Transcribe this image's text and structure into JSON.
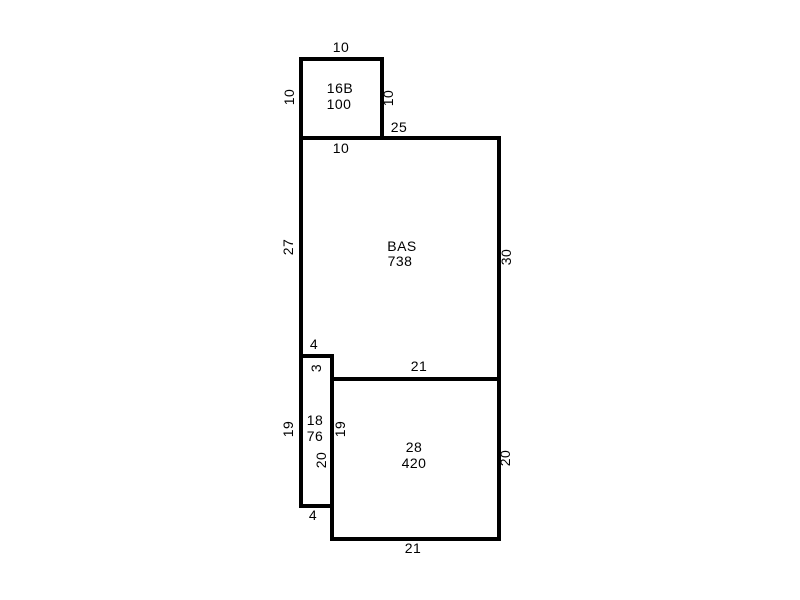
{
  "sketch": {
    "background_color": "#ffffff",
    "line_color": "#000000",
    "rooms": [
      {
        "name": "16B",
        "area": "100"
      },
      {
        "name": "BAS",
        "area": "738"
      },
      {
        "name": "18",
        "area": "76"
      },
      {
        "name": "28",
        "area": "420"
      }
    ],
    "dimensions": {
      "area16b_top": "10",
      "area16b_left": "10",
      "area16b_right": "10",
      "area16b_bottom": "10",
      "bas_top": "25",
      "bas_left": "27",
      "bas_right": "30",
      "step_top": "4",
      "step_side": "3",
      "area28_top": "21",
      "area18_left": "19",
      "area18_right": "19",
      "area18_lower": "20",
      "area28_right": "20",
      "area18_bottom": "4",
      "area28_bottom": "21"
    }
  }
}
